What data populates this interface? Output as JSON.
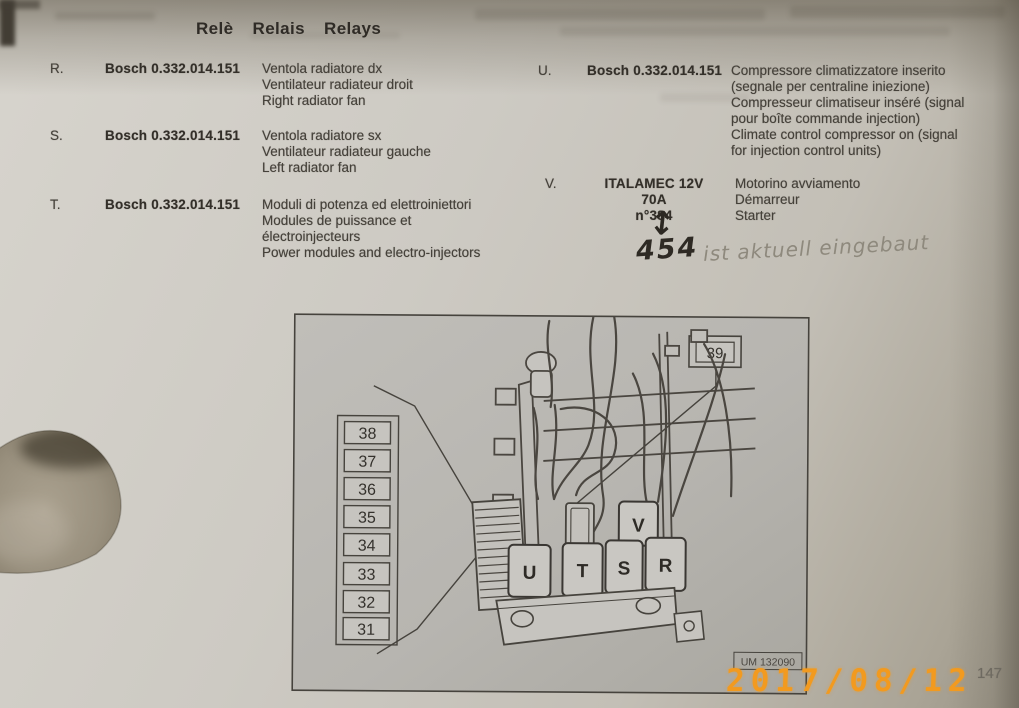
{
  "page": {
    "title_words": [
      "Relè",
      "Relais",
      "Relays"
    ],
    "page_number": "147",
    "date_stamp": "2017/08/12"
  },
  "entries": [
    {
      "id": "R.",
      "part": "Bosch 0.332.014.151",
      "desc": [
        "Ventola radiatore dx",
        "Ventilateur radiateur droit",
        "Right radiator fan"
      ]
    },
    {
      "id": "S.",
      "part": "Bosch 0.332.014.151",
      "desc": [
        "Ventola radiatore sx",
        "Ventilateur radiateur gauche",
        "Left radiator fan"
      ]
    },
    {
      "id": "T.",
      "part": "Bosch 0.332.014.151",
      "desc": [
        "Moduli di potenza ed elettroiniettori",
        "Modules de puissance et",
        "électroinjecteurs",
        "Power modules and electro-injectors"
      ]
    },
    {
      "id": "U.",
      "part": "Bosch 0.332.014.151",
      "desc": [
        "Compressore climatizzatore inserito",
        "(segnale per centraline iniezione)",
        "Compresseur climatiseur inséré (signal",
        "pour boîte commande injection)",
        "Climate control compressor on (signal",
        "for injection control units)"
      ]
    },
    {
      "id": "V.",
      "part": "ITALAMEC 12V 70A",
      "part2": "n°384",
      "desc": [
        "Motorino avviamento",
        "Démarreur",
        "Starter"
      ]
    }
  ],
  "handwriting": {
    "arrow": "↕",
    "number": "454",
    "note": "ist aktuell eingebaut"
  },
  "diagram": {
    "fuse_labels": [
      "38",
      "37",
      "36",
      "35",
      "34",
      "33",
      "32",
      "31"
    ],
    "top_label": "39",
    "relays": [
      "U",
      "T",
      "S",
      "R"
    ],
    "relay_v": "V",
    "ref": "UM 132090"
  },
  "colors": {
    "date_stamp": "#f29a1f",
    "paper": "#cdcac3",
    "ink": "#45413a"
  }
}
